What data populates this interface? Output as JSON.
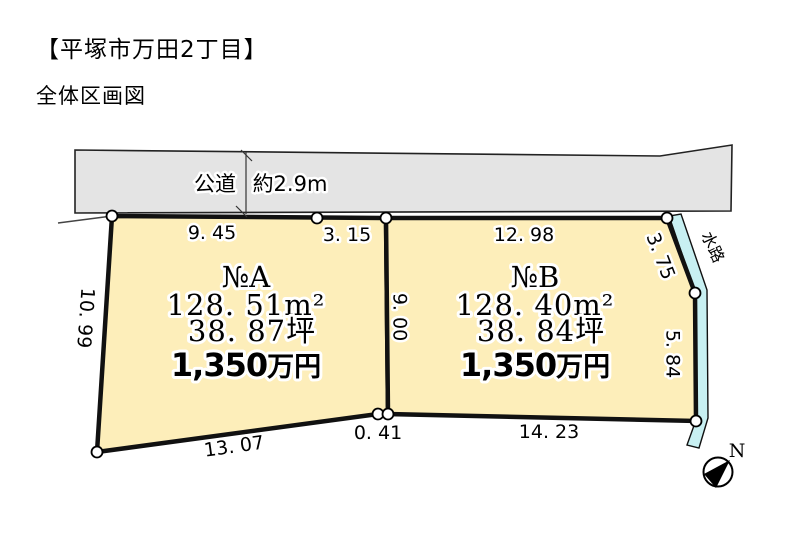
{
  "page": {
    "title": "【平塚市万田2丁目】",
    "subtitle": "全体区画図"
  },
  "road": {
    "label": "公道",
    "width": "約2.9m"
  },
  "waterway": {
    "label": "水路"
  },
  "compass": {
    "north": "N"
  },
  "lots": {
    "a": {
      "name": "№A",
      "area_m2": "128. 51m²",
      "area_tsubo": "38. 87坪",
      "price_value": "1,350",
      "price_unit": "万円"
    },
    "b": {
      "name": "№B",
      "area_m2": "128. 40m²",
      "area_tsubo": "38. 84坪",
      "price_value": "1,350",
      "price_unit": "万円"
    }
  },
  "dimensions": {
    "a_top_left": "9. 45",
    "a_top_right": "3. 15",
    "a_left": "10. 99",
    "a_bottom": "13. 07",
    "center_divider": "9. 00",
    "bottom_gap": "0. 41",
    "b_top": "12. 98",
    "b_right_upper": "3. 75",
    "b_right_lower": "5. 84",
    "b_bottom": "14. 23"
  },
  "colors": {
    "lot_fill": "#FDEEBA",
    "road_fill": "#E4E4E4",
    "water_fill": "#C8F0F2",
    "outline": "#111111"
  }
}
